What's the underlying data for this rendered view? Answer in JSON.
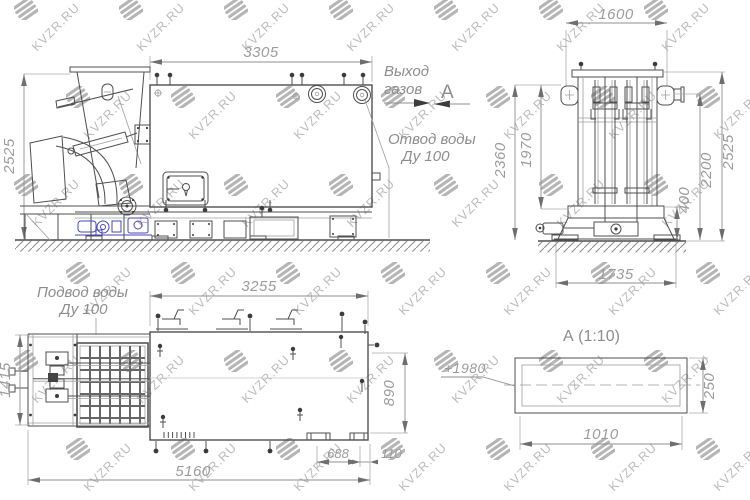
{
  "watermark": {
    "text": "KVZR.RU"
  },
  "side_view": {
    "dim_width": "3305",
    "dim_height": "2525",
    "gas_outlet": [
      "Выход",
      "газов"
    ],
    "section_arrow_label": "А",
    "water_drain": [
      "Отвод воды",
      "Ду 100"
    ]
  },
  "end_view": {
    "dim_width_top": "1600",
    "dim_height_outer": "2360",
    "dim_height_inner": "1970",
    "dim_base": "400",
    "dim_height_2200": "2200",
    "dim_height_right": "2525",
    "dim_width_bottom": "1735"
  },
  "plan_view": {
    "water_supply": [
      "Подвод воды",
      "Ду 100"
    ],
    "dim_width_top": "3255",
    "dim_height_left": "1415",
    "dim_height_right": "890",
    "dim_width_bottom": "5160",
    "dim_offset_688": "688",
    "dim_offset_110": "110"
  },
  "detail_view": {
    "title": "А  (1:10)",
    "elevation": "+1980",
    "dim_width": "1010",
    "dim_height": "250"
  }
}
